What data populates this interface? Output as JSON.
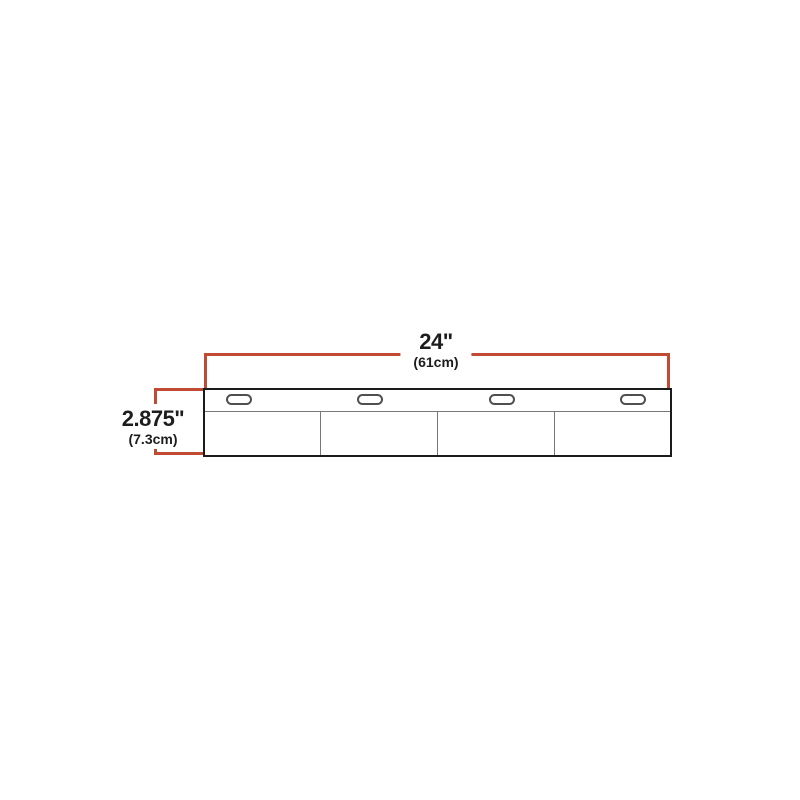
{
  "diagram": {
    "name": "product-dimension-diagram",
    "dimensions": {
      "width": {
        "imperial": "24\"",
        "metric": "(61cm)"
      },
      "height": {
        "imperial": "2.875\"",
        "metric": "(7.3cm)"
      }
    },
    "slot_count": 4,
    "panel_count": 4,
    "colors": {
      "dimension_line": "#c14a33",
      "outline": "#1b1b1b",
      "detail_line": "#787878",
      "slot_outline": "#4f4f4f",
      "background": "#ffffff"
    }
  }
}
